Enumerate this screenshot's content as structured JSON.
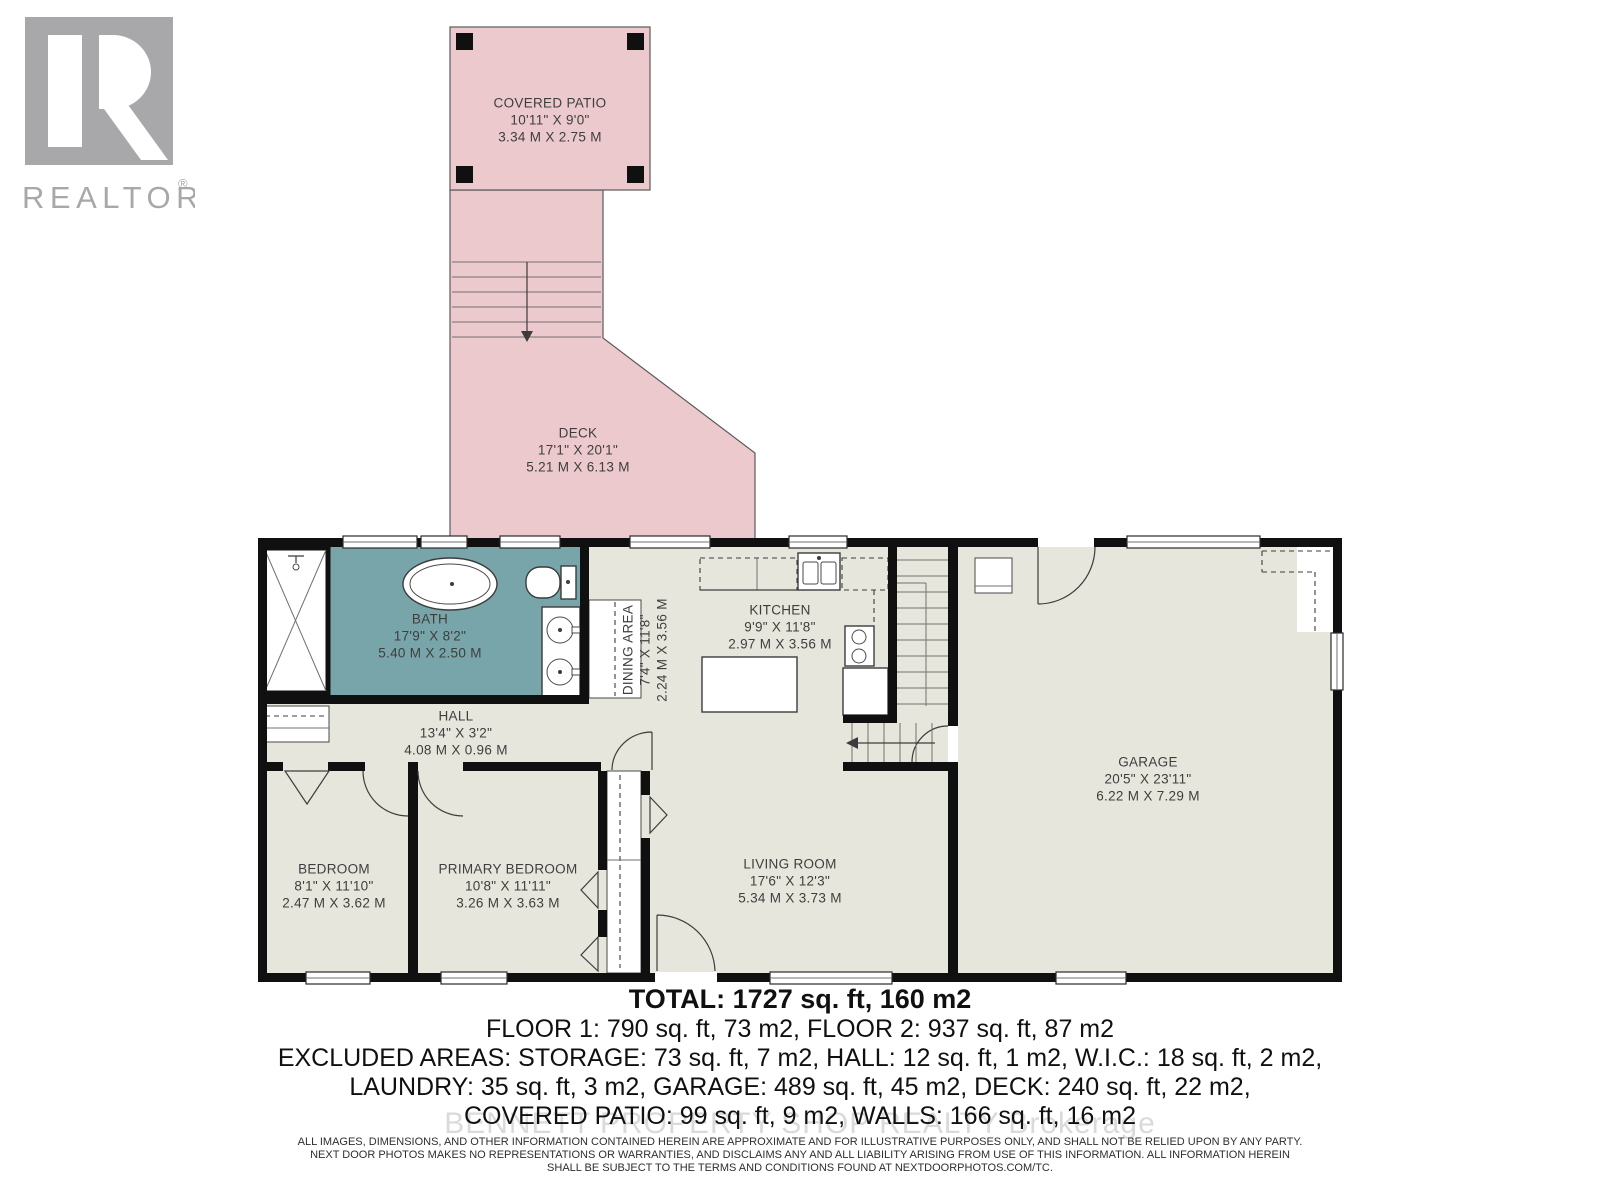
{
  "logo": {
    "brand": "REALTOR",
    "registered": "®"
  },
  "watermark": "BENNETT PROPERTY SHOP REALTY  Brokerage",
  "rooms": {
    "covered_patio": {
      "name": "COVERED PATIO",
      "imperial": "10'11\" X 9'0\"",
      "metric": "3.34 M X 2.75 M"
    },
    "deck": {
      "name": "DECK",
      "imperial": "17'1\" X 20'1\"",
      "metric": "5.21 M X 6.13 M"
    },
    "bath": {
      "name": "BATH",
      "imperial": "17'9\" X 8'2\"",
      "metric": "5.40 M X 2.50 M"
    },
    "dining": {
      "name": "DINING AREA",
      "imperial": "7'4\" X 11'8\"",
      "metric": "2.24 M X 3.56 M"
    },
    "kitchen": {
      "name": "KITCHEN",
      "imperial": "9'9\" X 11'8\"",
      "metric": "2.97 M X 3.56 M"
    },
    "hall": {
      "name": "HALL",
      "imperial": "13'4\" X 3'2\"",
      "metric": "4.08 M X 0.96 M"
    },
    "bedroom": {
      "name": "BEDROOM",
      "imperial": "8'1\" X 11'10\"",
      "metric": "2.47 M X 3.62 M"
    },
    "primary_bedroom": {
      "name": "PRIMARY BEDROOM",
      "imperial": "10'8\" X 11'11\"",
      "metric": "3.26 M X 3.63 M"
    },
    "living_room": {
      "name": "LIVING ROOM",
      "imperial": "17'6\" X 12'3\"",
      "metric": "5.34 M X 3.73 M"
    },
    "garage": {
      "name": "GARAGE",
      "imperial": "20'5\" X 23'11\"",
      "metric": "6.22 M X 7.29 M"
    }
  },
  "summary": {
    "total": "TOTAL: 1727 sq. ft, 160 m2",
    "floors": "FLOOR 1: 790 sq. ft, 73 m2, FLOOR 2: 937 sq. ft, 87 m2",
    "excluded_line1": "EXCLUDED AREAS: STORAGE: 73 sq. ft, 7 m2, HALL: 12 sq. ft, 1 m2, W.I.C.: 18 sq. ft, 2 m2,",
    "excluded_line2": "LAUNDRY: 35 sq. ft, 3 m2, GARAGE: 489 sq. ft, 45 m2, DECK: 240 sq. ft, 22 m2,",
    "excluded_line3": "COVERED PATIO: 99 sq. ft, 9 m2, WALLS: 166 sq. ft, 16 m2"
  },
  "disclaimer": {
    "line1": "ALL IMAGES, DIMENSIONS, AND OTHER INFORMATION CONTAINED HEREIN ARE APPROXIMATE AND FOR ILLUSTRATIVE PURPOSES ONLY, AND SHALL NOT BE RELIED UPON BY ANY PARTY.",
    "line2": "NEXT DOOR PHOTOS MAKES NO REPRESENTATIONS OR WARRANTIES, AND DISCLAIMS ANY AND ALL LIABILITY ARISING FROM USE OF THIS INFORMATION. ALL INFORMATION HEREIN",
    "line3": "SHALL BE SUBJECT TO THE TERMS AND CONDITIONS FOUND AT NEXTDOORPHOTOS.COM/TC."
  },
  "colors": {
    "deck": "#ecc9cd",
    "bath": "#78a5aa",
    "floor": "#e7e6dc",
    "wall": "#101010",
    "logo": "#a8a8aa"
  }
}
